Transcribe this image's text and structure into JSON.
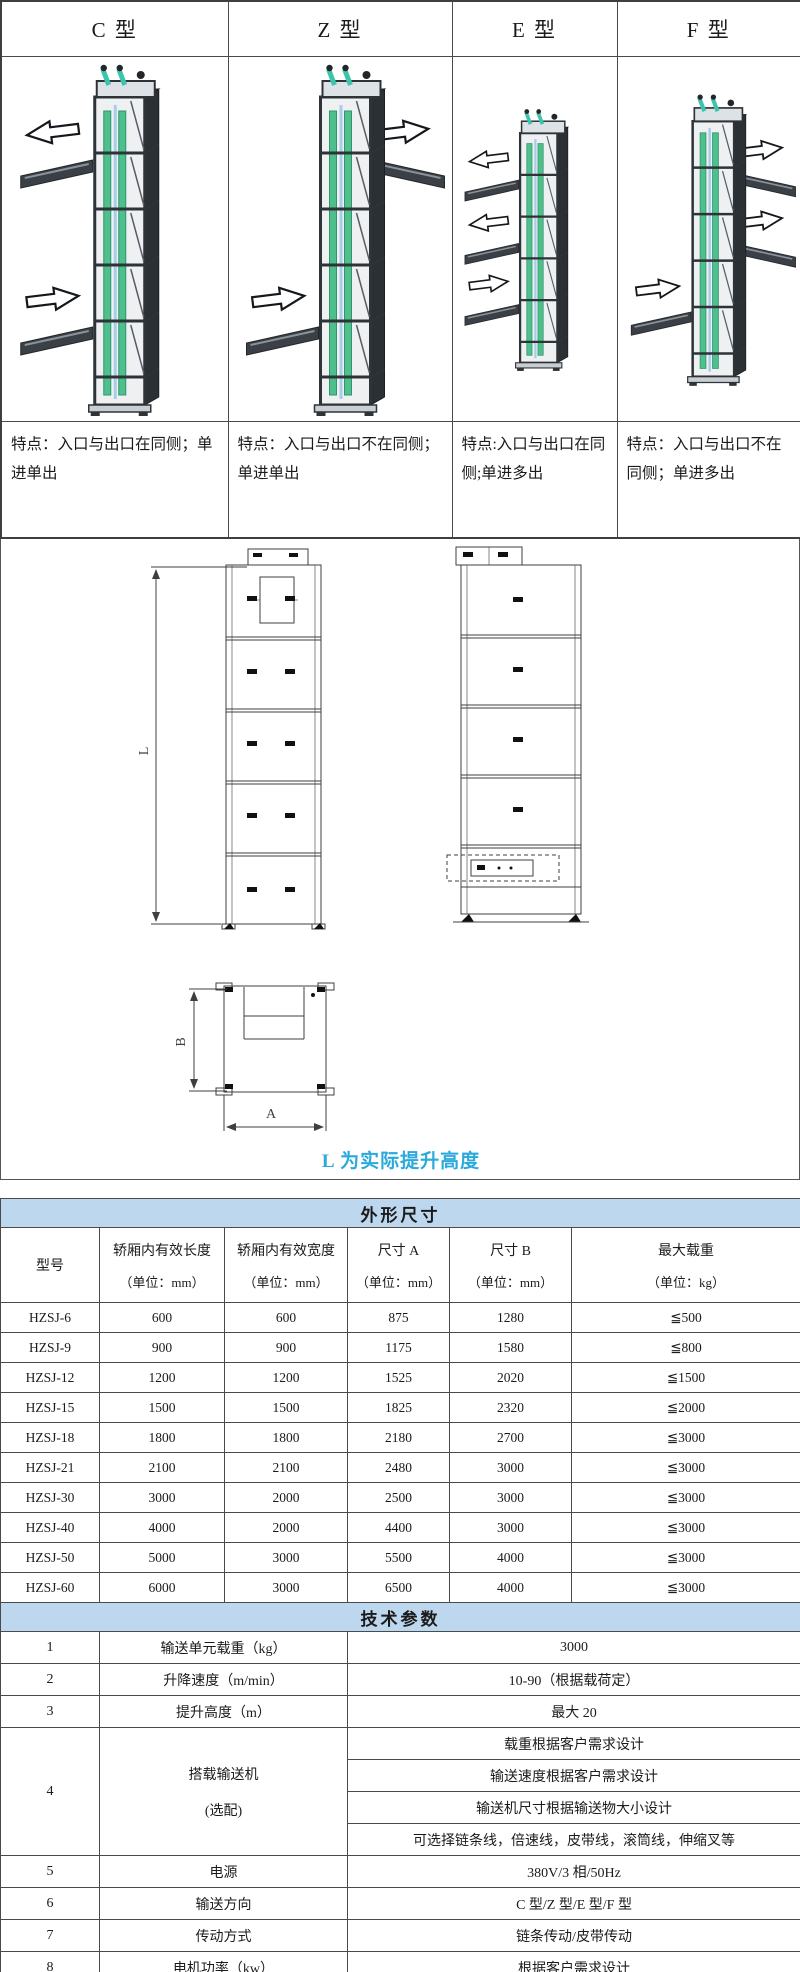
{
  "colors": {
    "table_header_bg": "#bdd7ee",
    "caption_blue": "#29a9dc",
    "belt_green": "#4fbf8d",
    "frame_dark": "#2e3338"
  },
  "type_table": {
    "columns": [
      {
        "label": "C 型",
        "feature": "特点：入口与出口在同侧；单进单出",
        "flow": {
          "inlet": {
            "level": "bottom",
            "side": "left"
          },
          "outlets": [
            {
              "level": "top",
              "side": "left"
            }
          ]
        }
      },
      {
        "label": "Z 型",
        "feature": "特点：入口与出口不在同侧；单进单出",
        "flow": {
          "inlet": {
            "level": "bottom",
            "side": "left"
          },
          "outlets": [
            {
              "level": "top",
              "side": "right"
            }
          ]
        }
      },
      {
        "label": "E 型",
        "feature": "特点:入口与出口在同侧;单进多出",
        "flow": {
          "inlet": {
            "level": "bottom",
            "side": "left"
          },
          "outlets": [
            {
              "level": "top",
              "side": "left"
            },
            {
              "level": "middle",
              "side": "left"
            }
          ]
        }
      },
      {
        "label": "F 型",
        "feature": "特点：入口与出口不在同侧；单进多出",
        "flow": {
          "inlet": {
            "level": "bottom",
            "side": "left"
          },
          "outlets": [
            {
              "level": "top",
              "side": "right"
            },
            {
              "level": "middle",
              "side": "right"
            }
          ]
        }
      }
    ]
  },
  "drawing": {
    "labels": {
      "height": "L",
      "width": "A",
      "depth": "B"
    },
    "caption": "L 为实际提升高度",
    "caption_color": "#29a9dc"
  },
  "dimension_table": {
    "title": "外形尺寸",
    "columns": [
      {
        "name": "型号",
        "unit": ""
      },
      {
        "name": "轿厢内有效长度",
        "unit": "（单位：mm）"
      },
      {
        "name": "轿厢内有效宽度",
        "unit": "（单位：mm）"
      },
      {
        "name": "尺寸 A",
        "unit": "（单位：mm）"
      },
      {
        "name": "尺寸 B",
        "unit": "（单位：mm）"
      },
      {
        "name": "最大载重",
        "unit": "（单位：kg）"
      }
    ],
    "rows": [
      [
        "HZSJ-6",
        "600",
        "600",
        "875",
        "1280",
        "≦500"
      ],
      [
        "HZSJ-9",
        "900",
        "900",
        "1175",
        "1580",
        "≦800"
      ],
      [
        "HZSJ-12",
        "1200",
        "1200",
        "1525",
        "2020",
        "≦1500"
      ],
      [
        "HZSJ-15",
        "1500",
        "1500",
        "1825",
        "2320",
        "≦2000"
      ],
      [
        "HZSJ-18",
        "1800",
        "1800",
        "2180",
        "2700",
        "≦3000"
      ],
      [
        "HZSJ-21",
        "2100",
        "2100",
        "2480",
        "3000",
        "≦3000"
      ],
      [
        "HZSJ-30",
        "3000",
        "2000",
        "2500",
        "3000",
        "≦3000"
      ],
      [
        "HZSJ-40",
        "4000",
        "2000",
        "4400",
        "3000",
        "≦3000"
      ],
      [
        "HZSJ-50",
        "5000",
        "3000",
        "5500",
        "4000",
        "≦3000"
      ],
      [
        "HZSJ-60",
        "6000",
        "3000",
        "6500",
        "4000",
        "≦3000"
      ]
    ]
  },
  "tech_table": {
    "title": "技术参数",
    "rows": [
      {
        "no": "1",
        "name": "输送单元载重（kg）",
        "values": [
          "3000"
        ]
      },
      {
        "no": "2",
        "name": "升降速度（m/min）",
        "values": [
          "10-90（根据载荷定）"
        ]
      },
      {
        "no": "3",
        "name": "提升高度（m）",
        "values": [
          "最大 20"
        ]
      },
      {
        "no": "4",
        "name": "搭载输送机",
        "name2": "(选配)",
        "values": [
          "载重根据客户需求设计",
          "输送速度根据客户需求设计",
          "输送机尺寸根据输送物大小设计",
          "可选择链条线，倍速线，皮带线，滚筒线，伸缩叉等"
        ]
      },
      {
        "no": "5",
        "name": "电源",
        "values": [
          "380V/3 相/50Hz"
        ]
      },
      {
        "no": "6",
        "name": "输送方向",
        "values": [
          "C 型/Z 型/E 型/F 型"
        ]
      },
      {
        "no": "7",
        "name": "传动方式",
        "values": [
          "链条传动/皮带传动"
        ]
      },
      {
        "no": "8",
        "name": "电机功率（kw）",
        "values": [
          "根据客户需求设计"
        ]
      }
    ],
    "note": "备注：以上参数仅供常规选型参考，本公司可根据行业特性及客户具体需求提供专项解决方案，详情请咨询销售工程师。"
  }
}
